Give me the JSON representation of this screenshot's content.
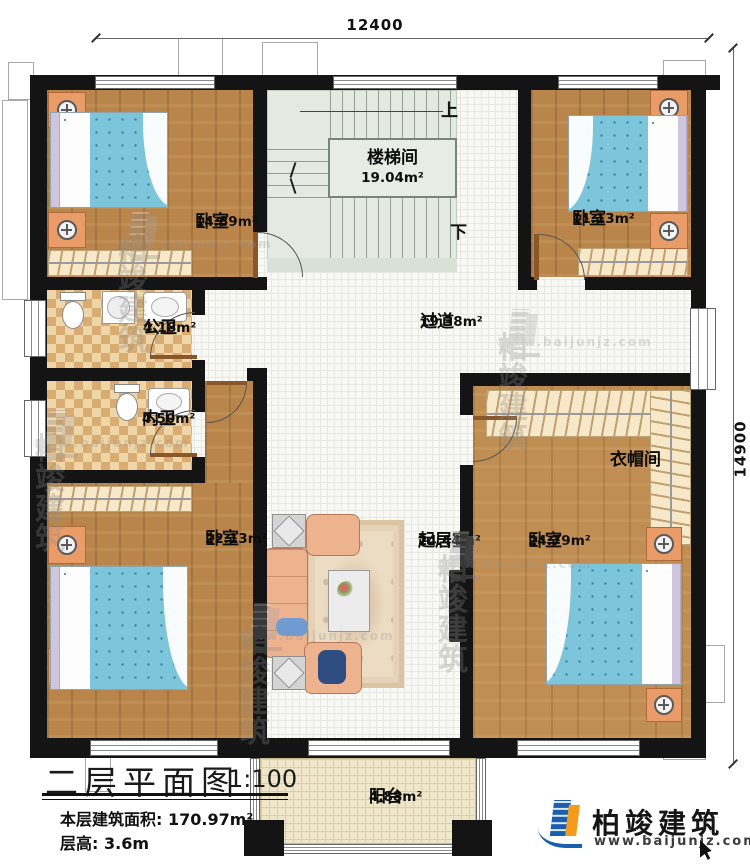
{
  "dimensions": {
    "top": "12400",
    "right": "14900"
  },
  "stairs": {
    "room": {
      "name": "楼梯间",
      "area": "19.04m²"
    },
    "up": "上",
    "down": "下"
  },
  "rooms": {
    "bedroom_tl": {
      "name": "卧室",
      "area": "14.89m²"
    },
    "bedroom_tr": {
      "name": "卧室",
      "area": "11.13m²"
    },
    "bedroom_bl": {
      "name": "卧室",
      "area": "22.13m²"
    },
    "bedroom_br": {
      "name": "卧室",
      "area": "24.79m²"
    },
    "public_bath": {
      "name": "公卫",
      "area": "4.18m²"
    },
    "ensuite_bath": {
      "name": "内卫",
      "area": "4.50m²"
    },
    "corridor": {
      "name": "过道",
      "area": "19.38m²"
    },
    "living": {
      "name": "起居室",
      "area": "24.44m²"
    },
    "cloakroom": {
      "name": "衣帽间"
    },
    "balcony": {
      "name": "阳台",
      "area": "4.88m²"
    }
  },
  "title_block": {
    "title": "二层平面图",
    "scale": "1:100",
    "area_label": "本层建筑面积:",
    "area_value": "170.97m²",
    "floor_height_label": "层高:",
    "floor_height_value": "3.6m"
  },
  "brand": {
    "name": "柏竣建筑",
    "website": "www.baijunjz.com"
  },
  "watermark": {
    "name": "柏竣建筑",
    "website": "www.baijunjz.com"
  },
  "colors": {
    "wall": "#141414",
    "wood": "#b9854b",
    "bed_blue": "#7cc5da",
    "brand_blue": "#1a5fae",
    "brand_orange": "#f29b1d"
  }
}
